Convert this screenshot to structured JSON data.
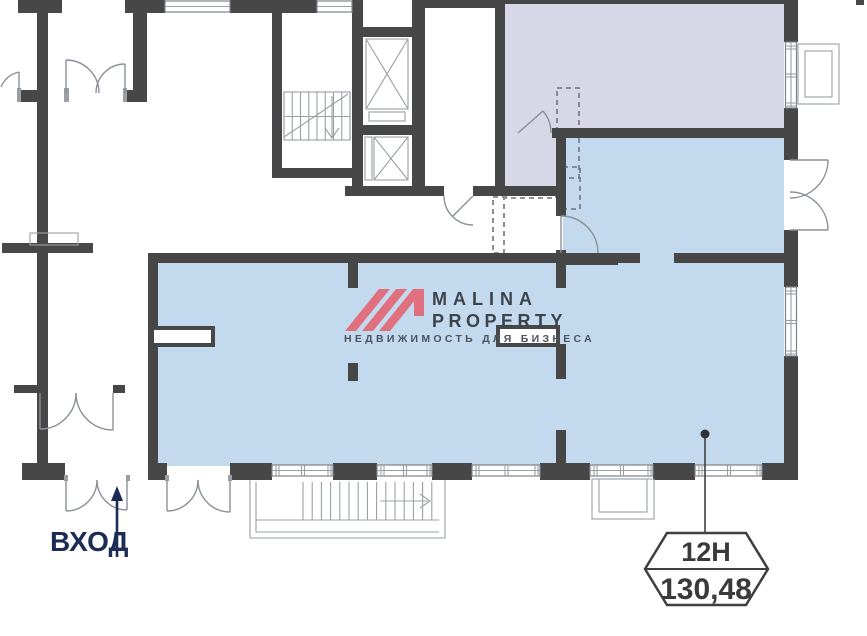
{
  "floor_plan": {
    "unit_badge": {
      "unit_number": "12Н",
      "area": "130,48"
    },
    "entrance": {
      "label": "ВХОД"
    },
    "watermark": {
      "brand_top": "MALINA",
      "brand_bottom": "PROPERTY",
      "tagline": "НЕДВИЖИМОСТЬ ДЛЯ БИЗНЕСА"
    },
    "colors": {
      "unit_area_fill": "#c3d9ed",
      "common_area_fill": "#d8d7e8",
      "walls": "#474747",
      "logo_accent": "#e0707e",
      "entrance_text": "#1c2c55",
      "badge_outline": "#3f3f3f"
    }
  }
}
